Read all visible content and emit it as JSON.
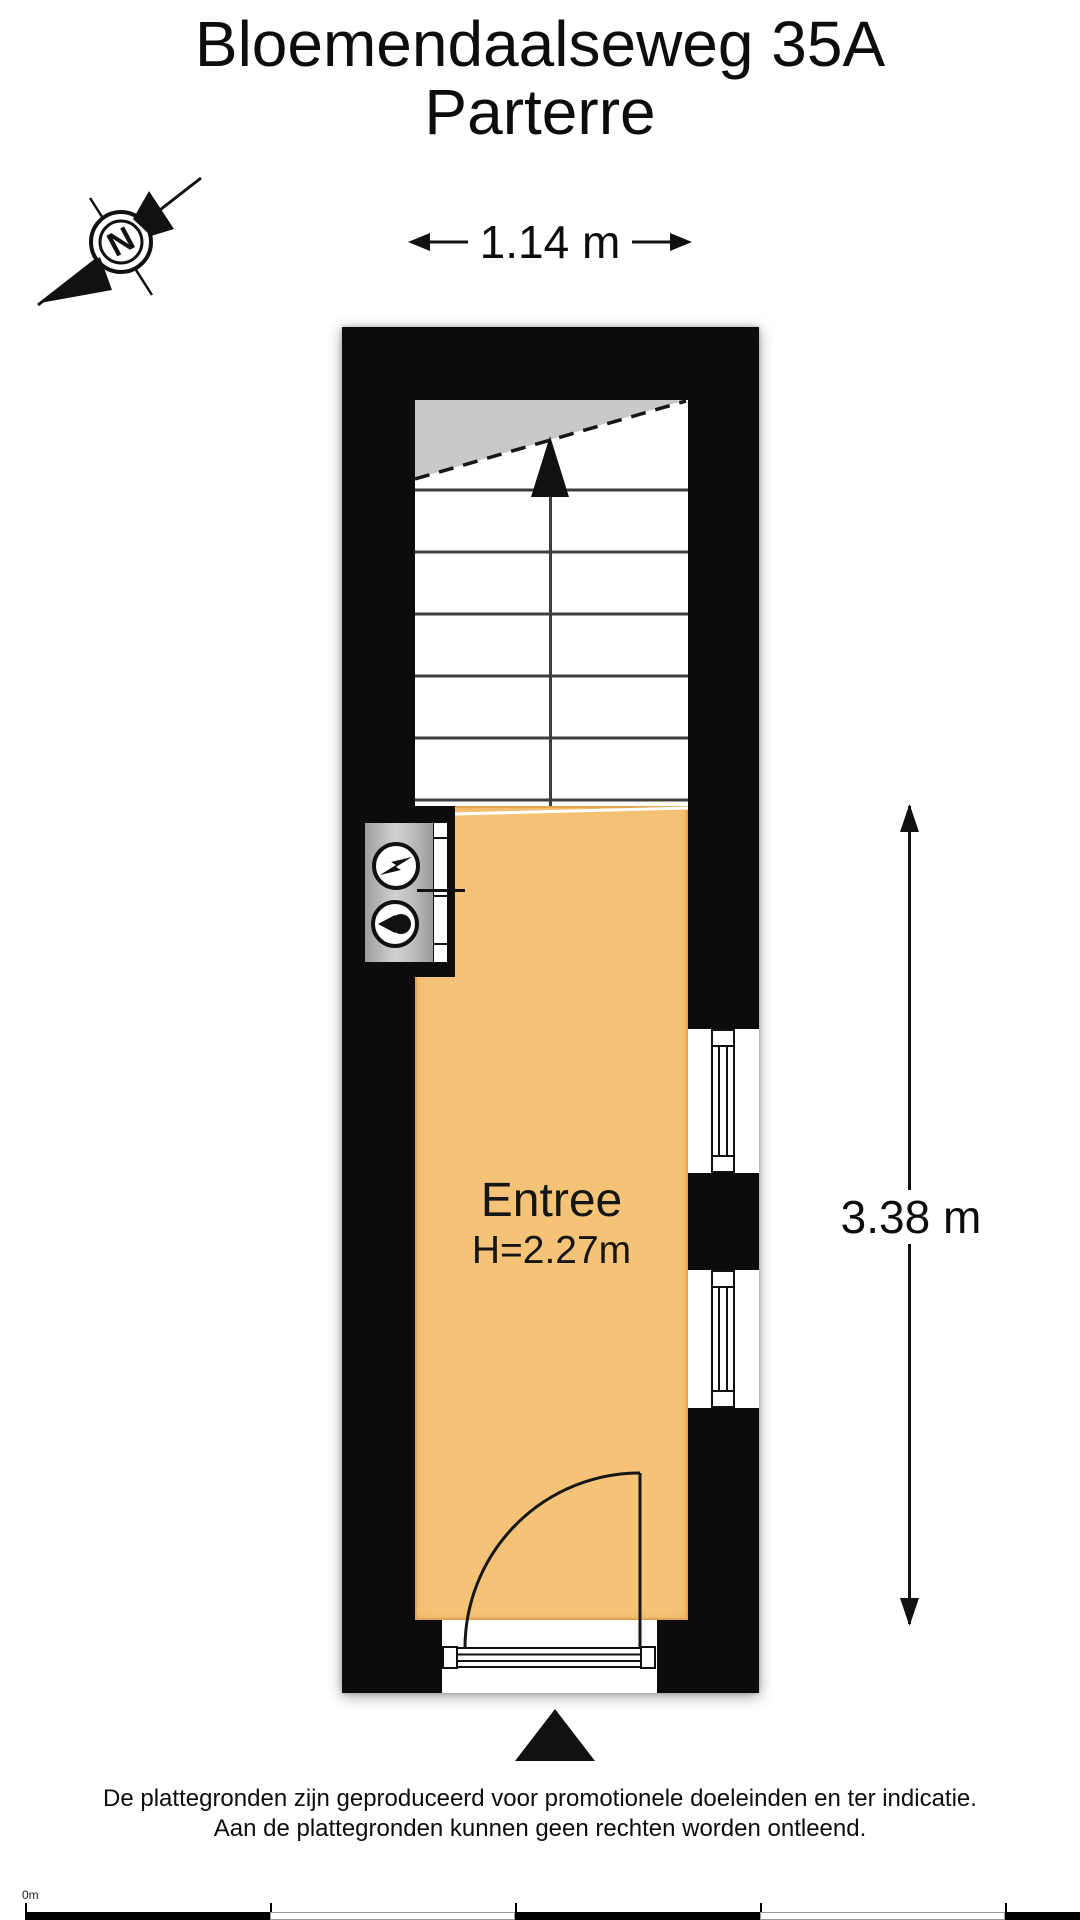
{
  "header": {
    "title_line1": "Bloemendaalseweg 35A",
    "title_line2": "Parterre"
  },
  "compass": {
    "letter": "N"
  },
  "dimensions": {
    "width_label": "1.14 m",
    "height_label": "3.38 m"
  },
  "room": {
    "name": "Entree",
    "ceiling_height": "H=2.27m"
  },
  "footer": {
    "disclaimer_line1": "De plattegronden zijn geproduceerd voor promotionele doeleinden en ter indicatie.",
    "disclaimer_line2": "Aan de plattegronden kunnen geen rechten worden ontleend.",
    "scale_origin_label": "0m"
  },
  "colors": {
    "wall": "#0c0c0c",
    "floor_fill": "#f5c377",
    "stair_cut_fill": "#c9c9c9",
    "cabinet_fill": "#b5b5b5"
  }
}
